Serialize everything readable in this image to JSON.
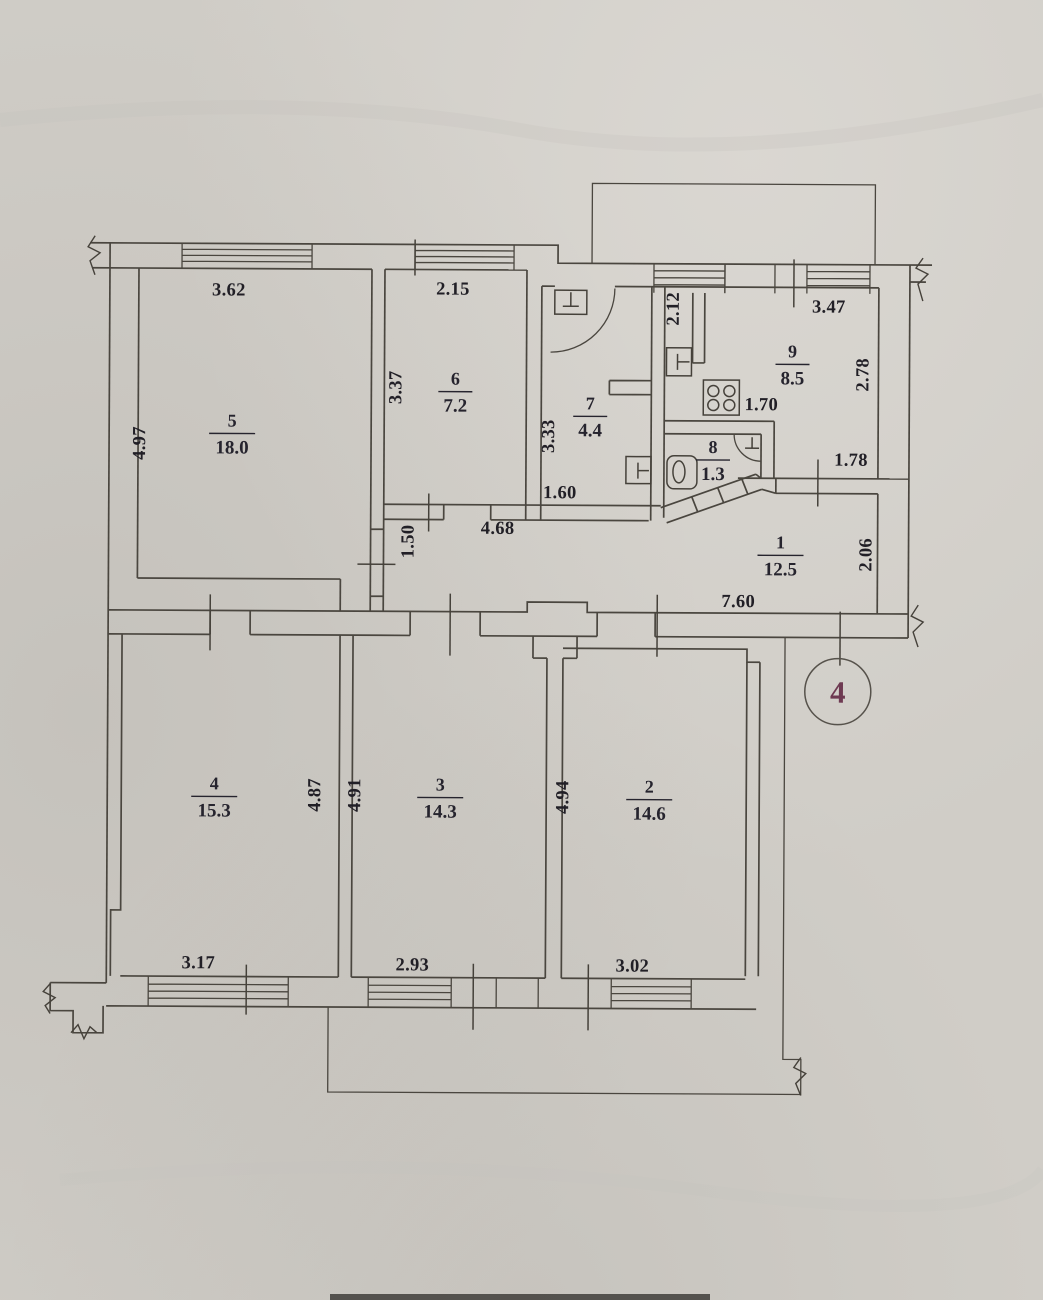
{
  "drawing": {
    "sheet_number": "4",
    "rooms": [
      {
        "number": "1",
        "area": "12.5",
        "x": 780,
        "y": 547
      },
      {
        "number": "2",
        "area": "14.6",
        "x": 650,
        "y": 792
      },
      {
        "number": "3",
        "area": "14.3",
        "x": 441,
        "y": 791
      },
      {
        "number": "4",
        "area": "15.3",
        "x": 215,
        "y": 791
      },
      {
        "number": "5",
        "area": "18.0",
        "x": 231,
        "y": 428
      },
      {
        "number": "6",
        "area": "7.2",
        "x": 454,
        "y": 385
      },
      {
        "number": "7",
        "area": "4.4",
        "x": 589,
        "y": 409
      },
      {
        "number": "8",
        "area": "1.3",
        "x": 712,
        "y": 452
      },
      {
        "number": "9",
        "area": "8.5",
        "x": 791,
        "y": 356
      }
    ],
    "dimensions": [
      {
        "text": "3.62",
        "x": 227,
        "y": 297,
        "rot": 0
      },
      {
        "text": "2.15",
        "x": 451,
        "y": 295,
        "rot": 0
      },
      {
        "text": "2.12",
        "x": 677,
        "y": 308,
        "rot": -90
      },
      {
        "text": "3.47",
        "x": 827,
        "y": 311,
        "rot": 0
      },
      {
        "text": "4.97",
        "x": 144,
        "y": 445,
        "rot": -90
      },
      {
        "text": "3.37",
        "x": 400,
        "y": 388,
        "rot": -90
      },
      {
        "text": "3.33",
        "x": 553,
        "y": 436,
        "rot": -90
      },
      {
        "text": "2.78",
        "x": 867,
        "y": 373,
        "rot": -90
      },
      {
        "text": "1.70",
        "x": 760,
        "y": 409,
        "rot": 0
      },
      {
        "text": "1.78",
        "x": 850,
        "y": 464,
        "rot": 0
      },
      {
        "text": "1.60",
        "x": 559,
        "y": 498,
        "rot": 0
      },
      {
        "text": "4.68",
        "x": 497,
        "y": 534,
        "rot": 0
      },
      {
        "text": "1.50",
        "x": 413,
        "y": 542,
        "rot": -90
      },
      {
        "text": "2.06",
        "x": 871,
        "y": 553,
        "rot": -90
      },
      {
        "text": "7.60",
        "x": 738,
        "y": 606,
        "rot": 0
      },
      {
        "text": "4.87",
        "x": 321,
        "y": 796,
        "rot": -90
      },
      {
        "text": "4.91",
        "x": 361,
        "y": 796,
        "rot": -90
      },
      {
        "text": "4.94",
        "x": 569,
        "y": 797,
        "rot": -90
      },
      {
        "text": "3.17",
        "x": 200,
        "y": 970,
        "rot": 0
      },
      {
        "text": "2.93",
        "x": 414,
        "y": 971,
        "rot": 0
      },
      {
        "text": "3.02",
        "x": 634,
        "y": 971,
        "rot": 0
      }
    ]
  }
}
